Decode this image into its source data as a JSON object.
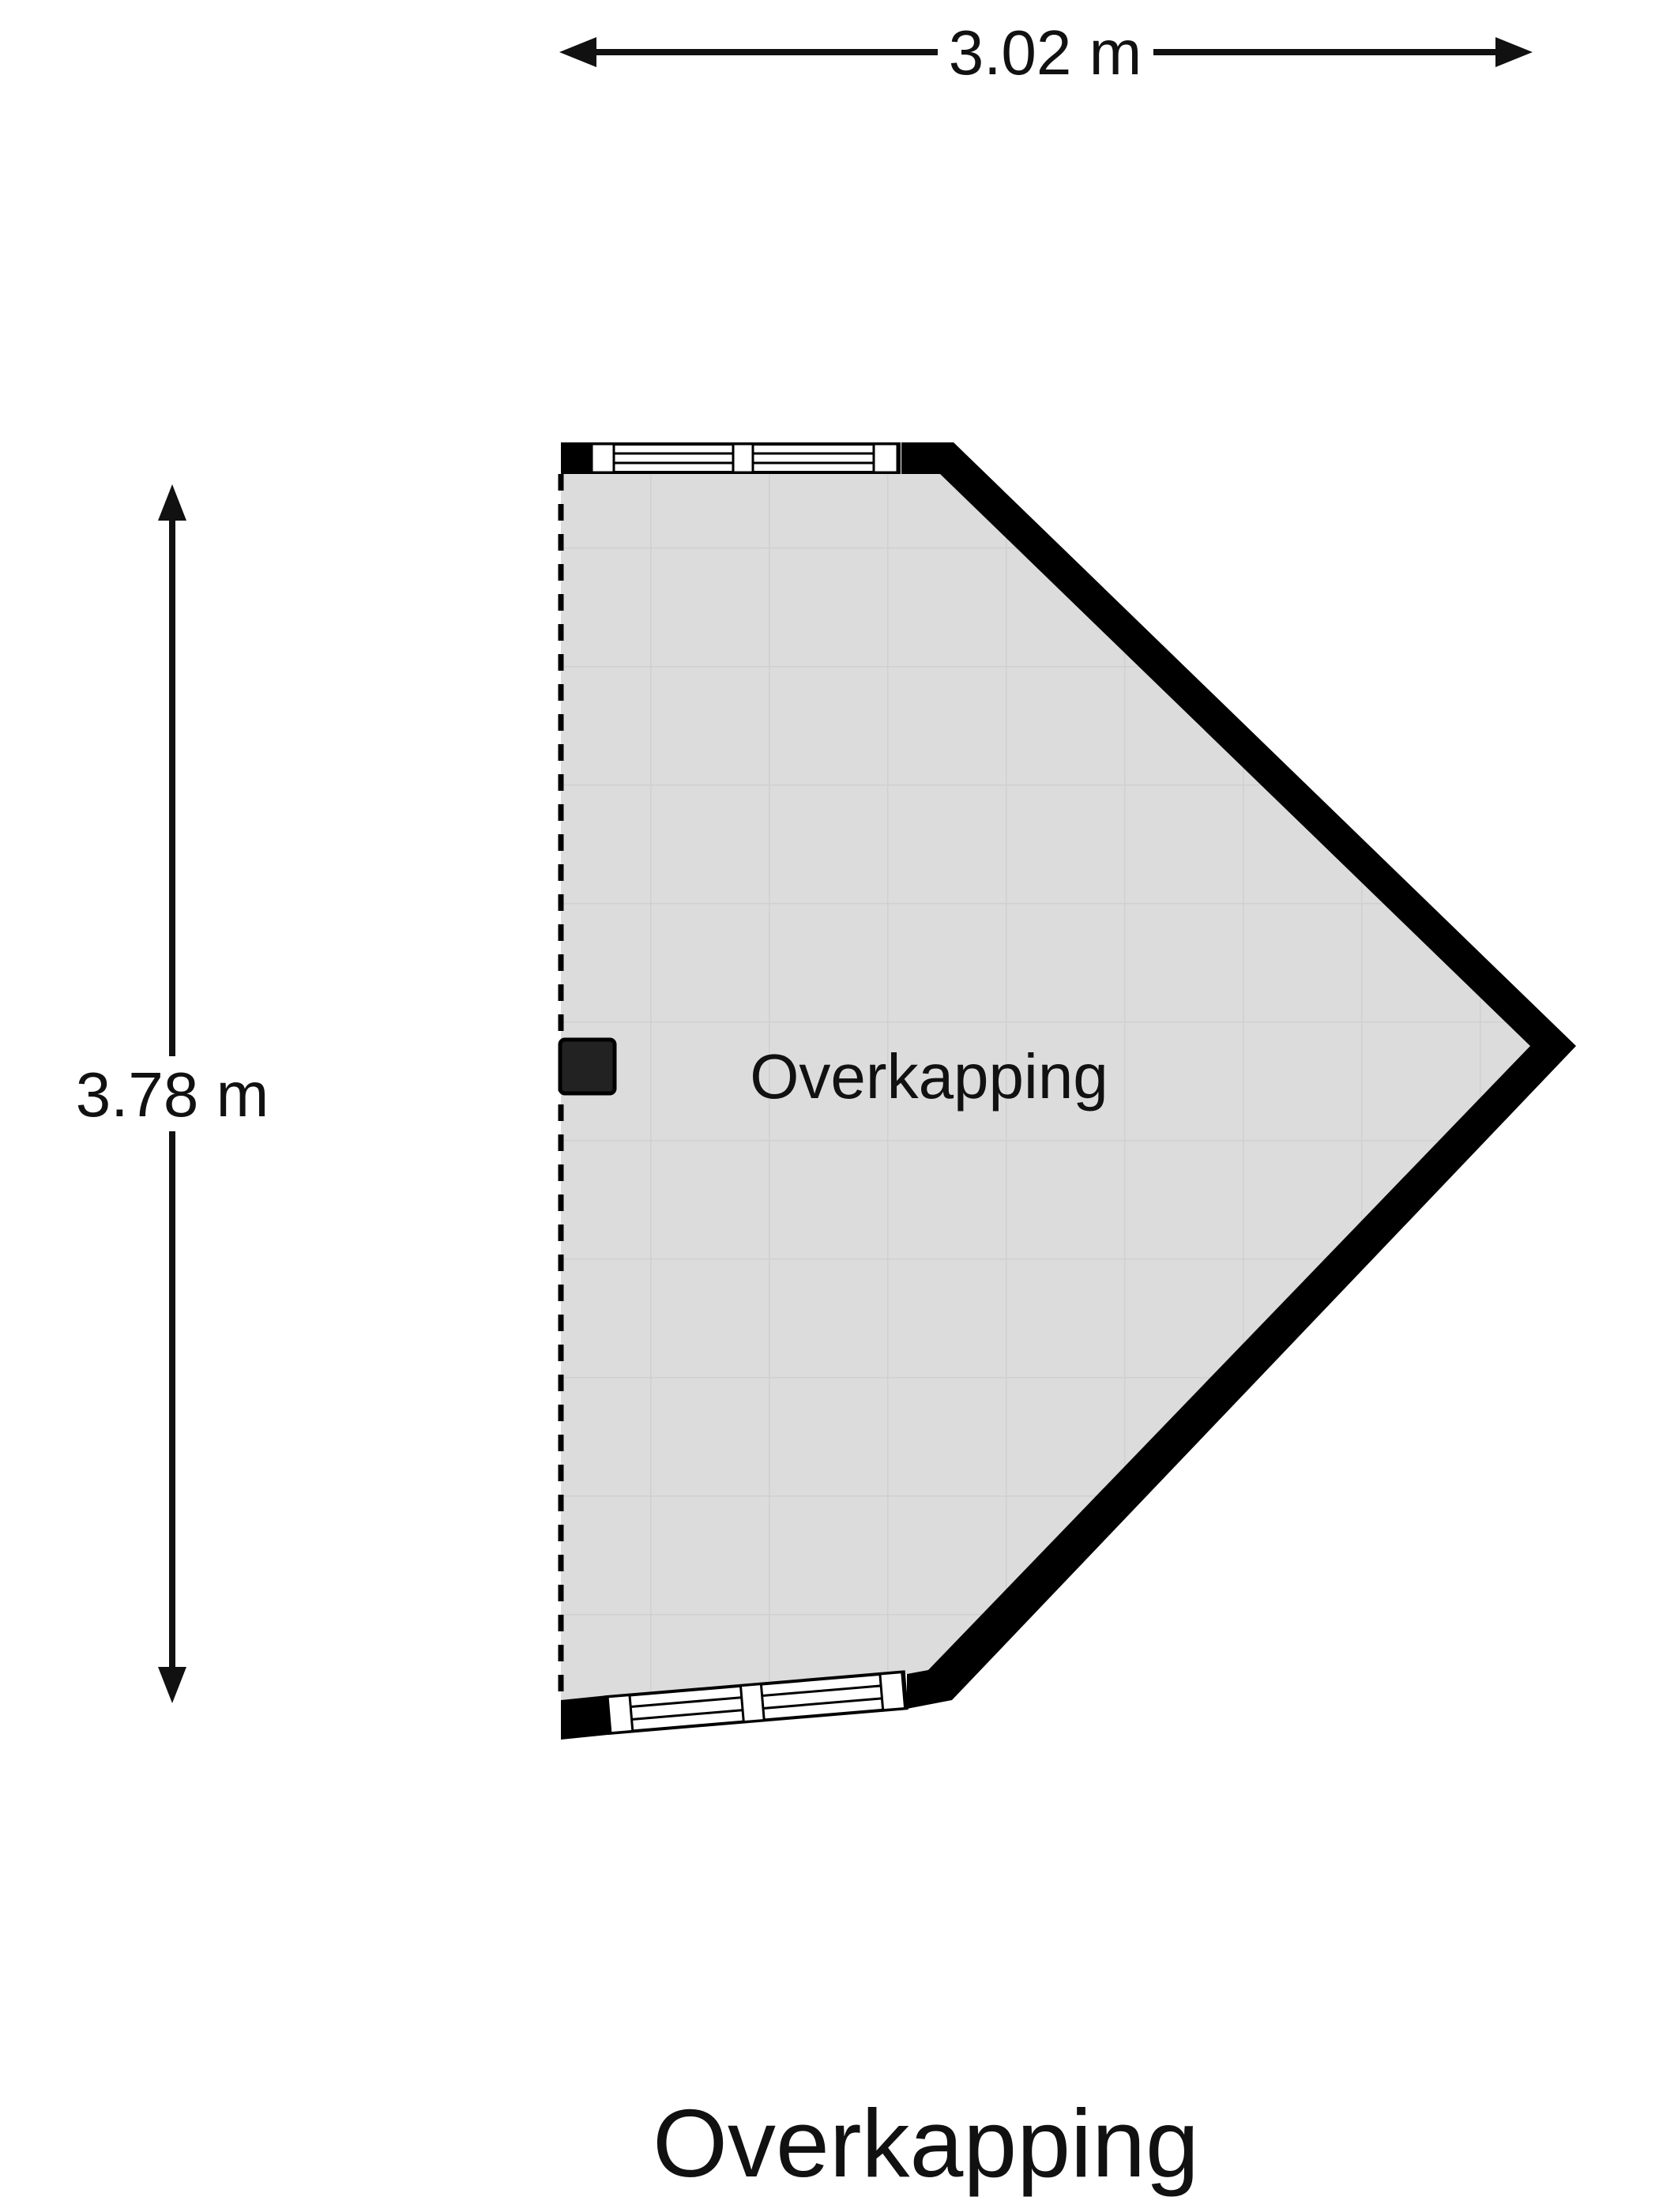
{
  "page": {
    "background": "#ffffff"
  },
  "dimensions": {
    "horizontal": {
      "label": "3.02 m"
    },
    "vertical": {
      "label": "3.78 m"
    }
  },
  "plan": {
    "room_label": "Overkapping",
    "title": "Overkapping"
  },
  "colors": {
    "background": "#ffffff",
    "wall": "#000000",
    "floor": "#dcdcdc",
    "grid": "#d0d0d0",
    "window": "#ffffff",
    "post": "#222222",
    "dim": "#111111",
    "text": "#111111"
  }
}
